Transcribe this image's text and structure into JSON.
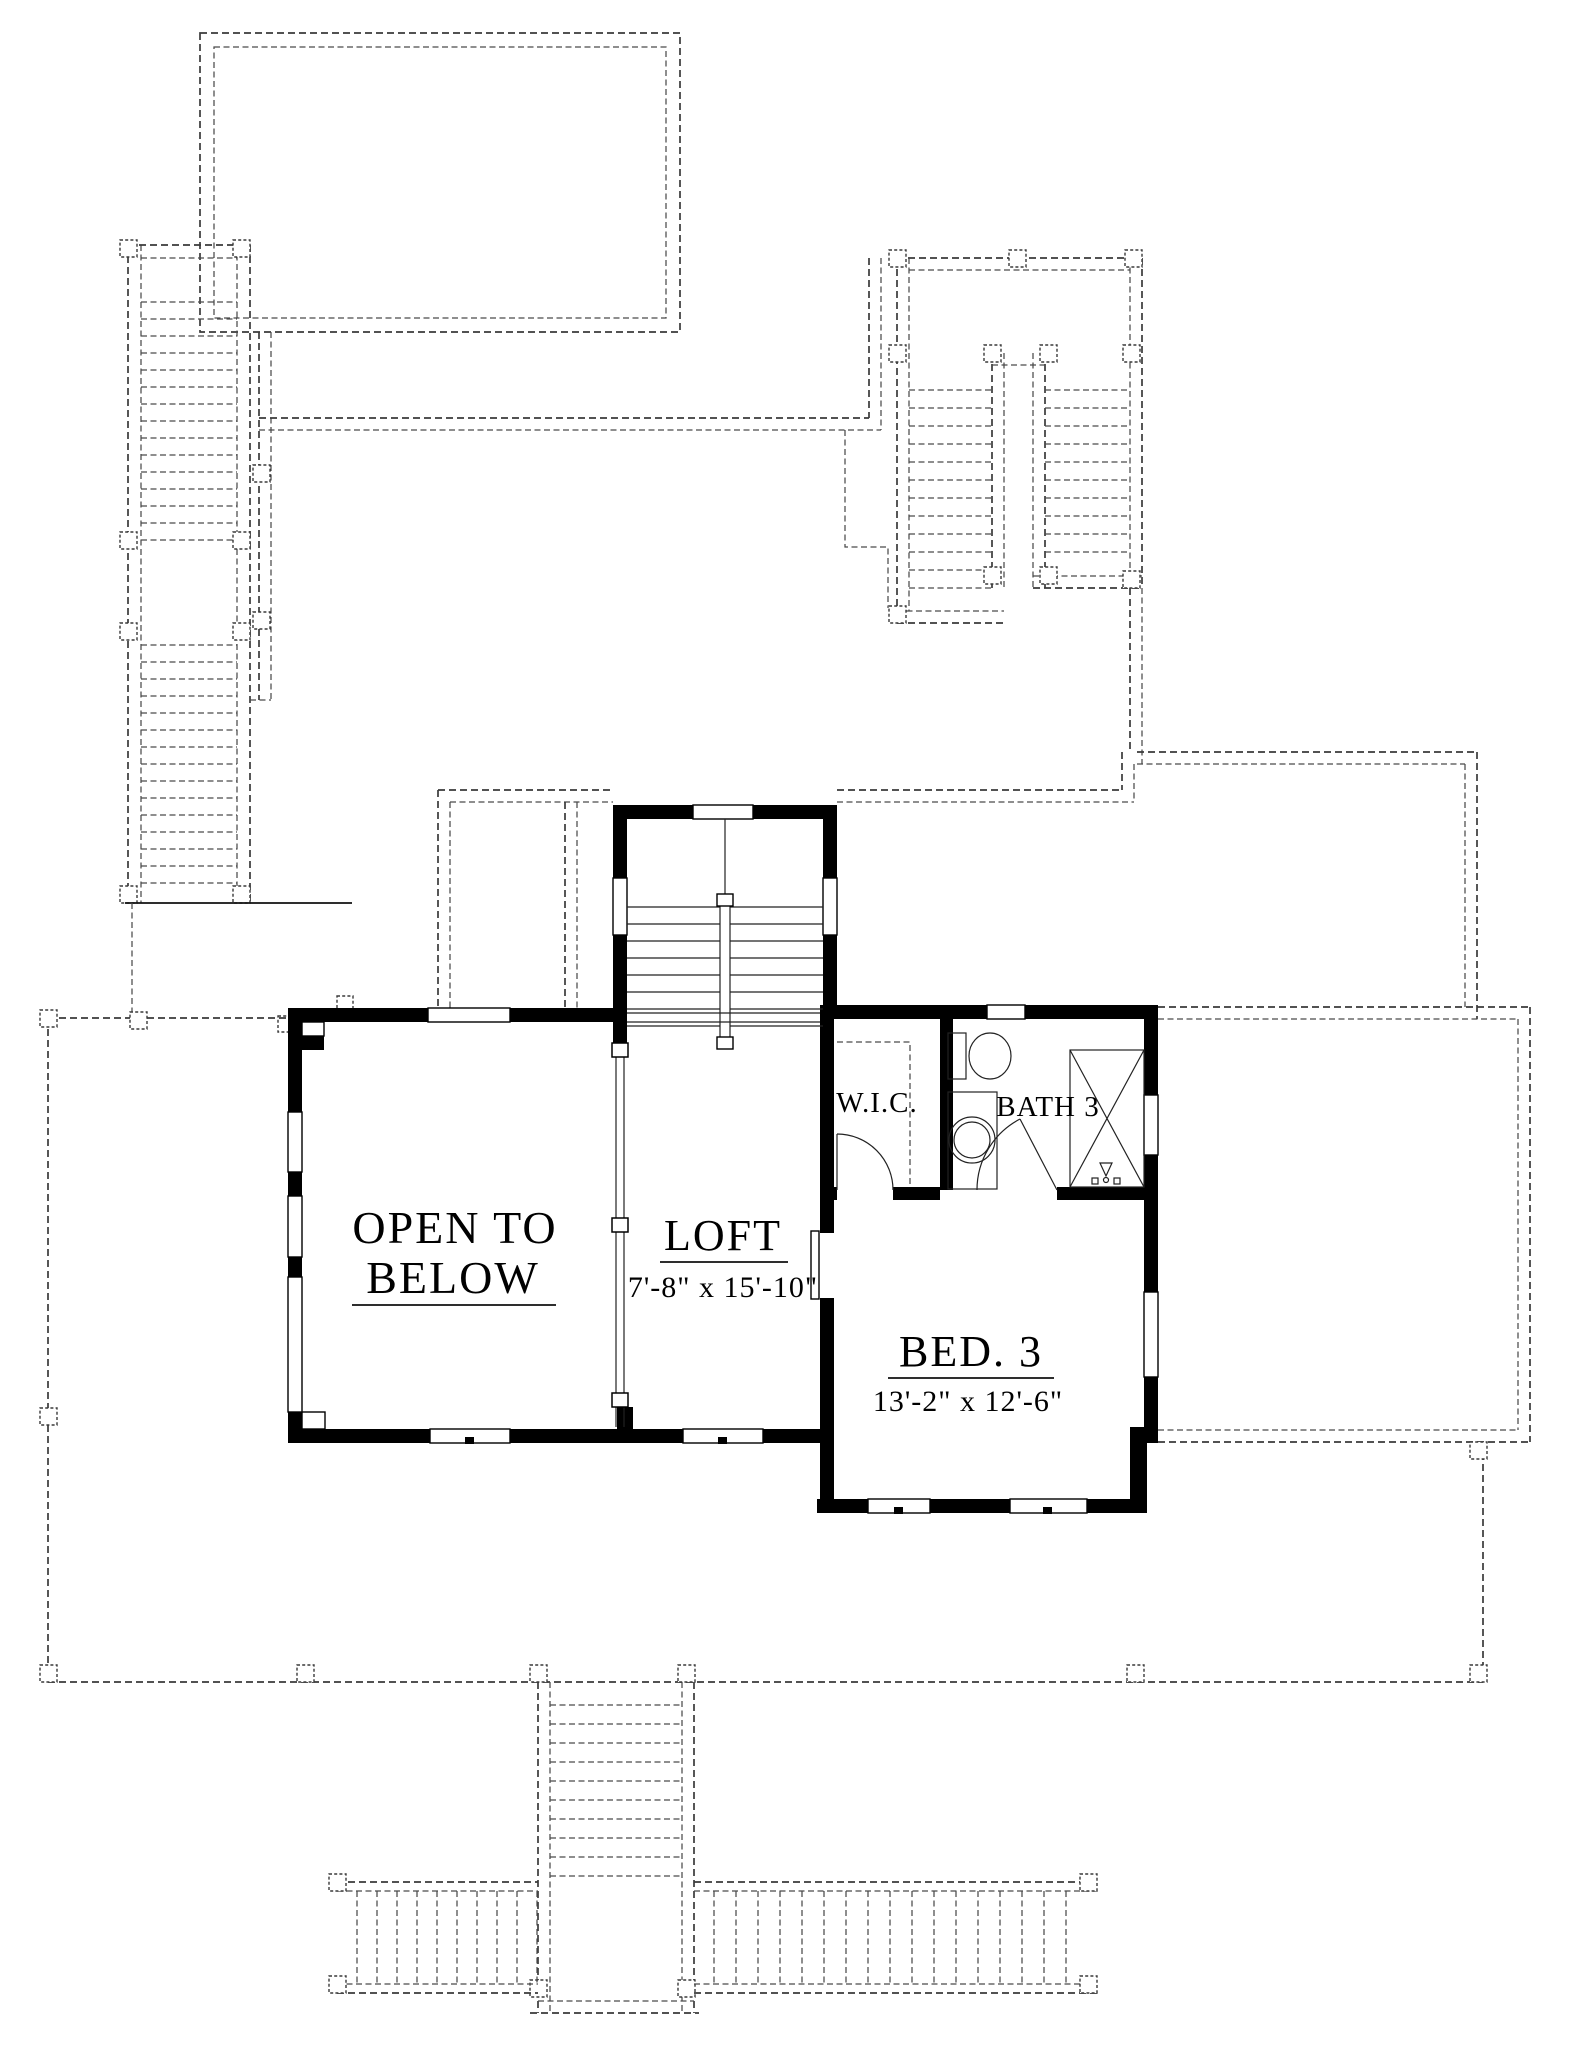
{
  "drawing": {
    "type": "floor-plan",
    "level": "upper-floor",
    "rooms": {
      "open_to_below": {
        "label_line1": "OPEN TO",
        "label_line2": "BELOW"
      },
      "loft": {
        "label": "LOFT",
        "dimensions": "7'-8\" x 15'-10\""
      },
      "wic": {
        "label": "W.I.C."
      },
      "bath3": {
        "label": "BATH 3"
      },
      "bed3": {
        "label": "BED. 3",
        "dimensions": "13'-2\" x 12'-6\""
      }
    },
    "colors": {
      "walls": "#000000",
      "lines": "#1a1a1a",
      "dashed_below_level": "#3a3a3a",
      "background": "#ffffff"
    }
  }
}
